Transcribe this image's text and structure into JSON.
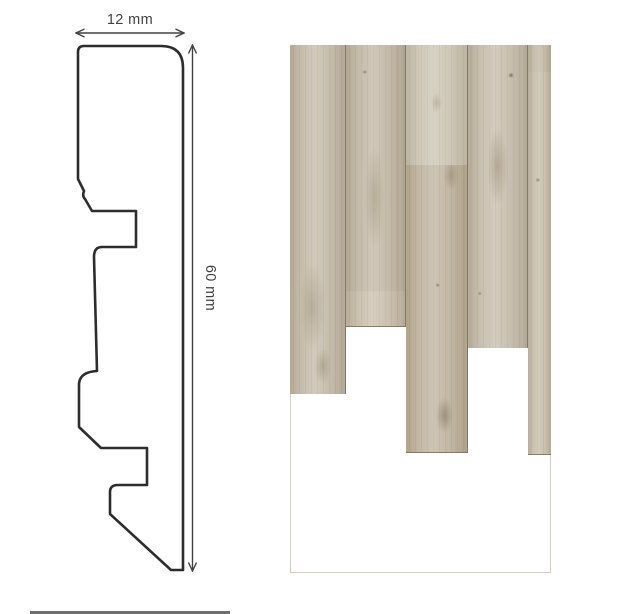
{
  "page": {
    "background": "#ffffff"
  },
  "diagram": {
    "stroke_color": "#2d2d2d",
    "dim_color": "#414141",
    "profile_fill": "#ffffff",
    "profile_path": "M 84,46 L 161,46 Q 183,46 183,68 L 183,570 L 171,570 L 110,514 L 110,492 Q 110,485 118,485 L 147,485 L 147,448 L 101,448 L 79,427 L 79,385 Q 79,372 97,371 L 94,257 Q 94,247 102,247 L 136,247 L 136,211 L 92,211 L 85,199 Q 82,196 84,191 L 78,179 L 78,52 Q 78,46 84,46 Z",
    "width_dimension": {
      "label": "12 mm",
      "orientation": "h",
      "tip1": {
        "x": 76,
        "y": 33
      },
      "tip2": {
        "x": 184,
        "y": 33
      },
      "label_pos": {
        "x": 130,
        "y": 24
      },
      "rotation": 0
    },
    "height_dimension": {
      "label": "60 mm",
      "orientation": "v",
      "tip1": {
        "x": 192.5,
        "y": 45
      },
      "tip2": {
        "x": 192.5,
        "y": 571
      },
      "label_pos": {
        "x": 206,
        "y": 288
      },
      "rotation": 90
    },
    "arrow_head": {
      "length": 8,
      "half_spread": 3.8
    }
  },
  "wood_panel": {
    "x": 290,
    "y": 45,
    "width": 261,
    "height": 528,
    "seam_color": "rgba(122,112,92,0.85)",
    "grain_dark": "rgba(96,85,66,0.07)",
    "grain_light": "rgba(255,255,255,0.12)",
    "columns": [
      {
        "w": 56,
        "segments": [
          {
            "h": 179,
            "base": "#c3b9a7",
            "light": "#cfc7b7",
            "dark": "#b2a794",
            "knots": [
              {
                "x": 22,
                "y": 50,
                "rx": 6,
                "ry": 70,
                "c": "rgba(140,128,106,0.5)"
              },
              {
                "x": 80,
                "y": 17,
                "rx": 3,
                "ry": 3,
                "c": "rgba(110,98,78,0.7)"
              }
            ]
          },
          {
            "h": 349,
            "base": "#c6bcaa",
            "light": "#d2cabb",
            "dark": "#b3a894",
            "knots": [
              {
                "x": 40,
                "y": 75,
                "rx": 18,
                "ry": 60,
                "c": "rgba(155,142,118,0.45)"
              },
              {
                "x": 60,
                "y": 92,
                "rx": 12,
                "ry": 24,
                "c": "rgba(150,136,112,0.45)"
              }
            ]
          }
        ]
      },
      {
        "w": 60,
        "segments": [
          {
            "h": 282,
            "base": "#cbc1ae",
            "light": "#d7cfc0",
            "dark": "#b7ac97",
            "knots": [
              {
                "x": 48,
                "y": 37,
                "rx": 14,
                "ry": 80,
                "c": "rgba(160,146,120,0.5)"
              },
              {
                "x": 48,
                "y": 76,
                "rx": 16,
                "ry": 50,
                "c": "rgba(158,144,118,0.45)"
              }
            ]
          },
          {
            "h": 246,
            "base": "#c4baa8",
            "light": "#d0c8b8",
            "dark": "#b1a691",
            "knots": [
              {
                "x": 48,
                "y": 62,
                "rx": 14,
                "ry": 70,
                "c": "rgba(158,144,118,0.45)"
              },
              {
                "x": 32,
                "y": 11,
                "rx": 3,
                "ry": 3,
                "c": "rgba(105,92,72,0.7)"
              }
            ]
          }
        ]
      },
      {
        "w": 62,
        "segments": [
          {
            "h": 408,
            "base": "#c2b7a3",
            "light": "#cec5b3",
            "dark": "#ada188",
            "knots": [
              {
                "x": 42,
                "y": 8,
                "rx": 4,
                "ry": 4,
                "c": "rgba(95,83,63,0.85)"
              },
              {
                "x": 80,
                "y": 16,
                "rx": 5,
                "ry": 8,
                "c": "rgba(110,98,78,0.75)"
              },
              {
                "x": 74,
                "y": 32,
                "rx": 10,
                "ry": 22,
                "c": "rgba(150,135,110,0.55)"
              },
              {
                "x": 52,
                "y": 59,
                "rx": 3,
                "ry": 3,
                "c": "rgba(105,92,72,0.7)"
              },
              {
                "x": 63,
                "y": 91,
                "rx": 12,
                "ry": 25,
                "c": "rgba(120,106,84,0.5)"
              }
            ]
          },
          {
            "h": 120,
            "base": "#cfc8b7",
            "light": "#d9d3c5",
            "dark": "#bdb4a1",
            "knots": [
              {
                "x": 50,
                "y": 48,
                "rx": 8,
                "ry": 14,
                "c": "rgba(165,152,128,0.5)"
              }
            ]
          }
        ]
      },
      {
        "w": 60,
        "segments": [
          {
            "h": 225,
            "base": "#cfc7b5",
            "light": "#dad3c4",
            "dark": "#bcb29e",
            "knots": [
              {
                "x": 53,
                "y": 51,
                "rx": 10,
                "ry": 40,
                "c": "rgba(165,150,124,0.5)"
              },
              {
                "x": 77,
                "y": 22,
                "rx": 3,
                "ry": 3,
                "c": "rgba(110,98,78,0.7)"
              }
            ]
          },
          {
            "h": 303,
            "base": "#c8bfae",
            "light": "#d4ccbd",
            "dark": "#b5aa96",
            "knots": [
              {
                "x": 50,
                "y": 40,
                "rx": 14,
                "ry": 55,
                "c": "rgba(150,136,112,0.5)"
              },
              {
                "x": 73,
                "y": 10,
                "rx": 4,
                "ry": 4,
                "c": "rgba(105,92,72,0.8)"
              },
              {
                "x": 20,
                "y": 82,
                "rx": 3,
                "ry": 3,
                "c": "rgba(110,98,78,0.6)"
              }
            ]
          }
        ]
      },
      {
        "w": 23,
        "segments": [
          {
            "h": 91,
            "base": "#cbc2b0",
            "light": "#d6cfc0",
            "dark": "#b9af9b",
            "knots": []
          },
          {
            "h": 410,
            "base": "#c9c0ad",
            "light": "#d4ccbc",
            "dark": "#b6ab97",
            "knots": [
              {
                "x": 52,
                "y": 5,
                "rx": 6,
                "ry": 12,
                "c": "rgba(224,218,204,0.6)"
              },
              {
                "x": 43,
                "y": 33,
                "rx": 3,
                "ry": 3,
                "c": "rgba(105,92,72,0.7)"
              }
            ]
          },
          {
            "h": 27,
            "base": "#c4bba9",
            "light": "#cfc7b6",
            "dark": "#b1a792",
            "knots": []
          }
        ]
      }
    ]
  },
  "divider": {
    "x": 30,
    "y": 611,
    "width": 200,
    "height": 3,
    "color": "#6f6f6f"
  }
}
